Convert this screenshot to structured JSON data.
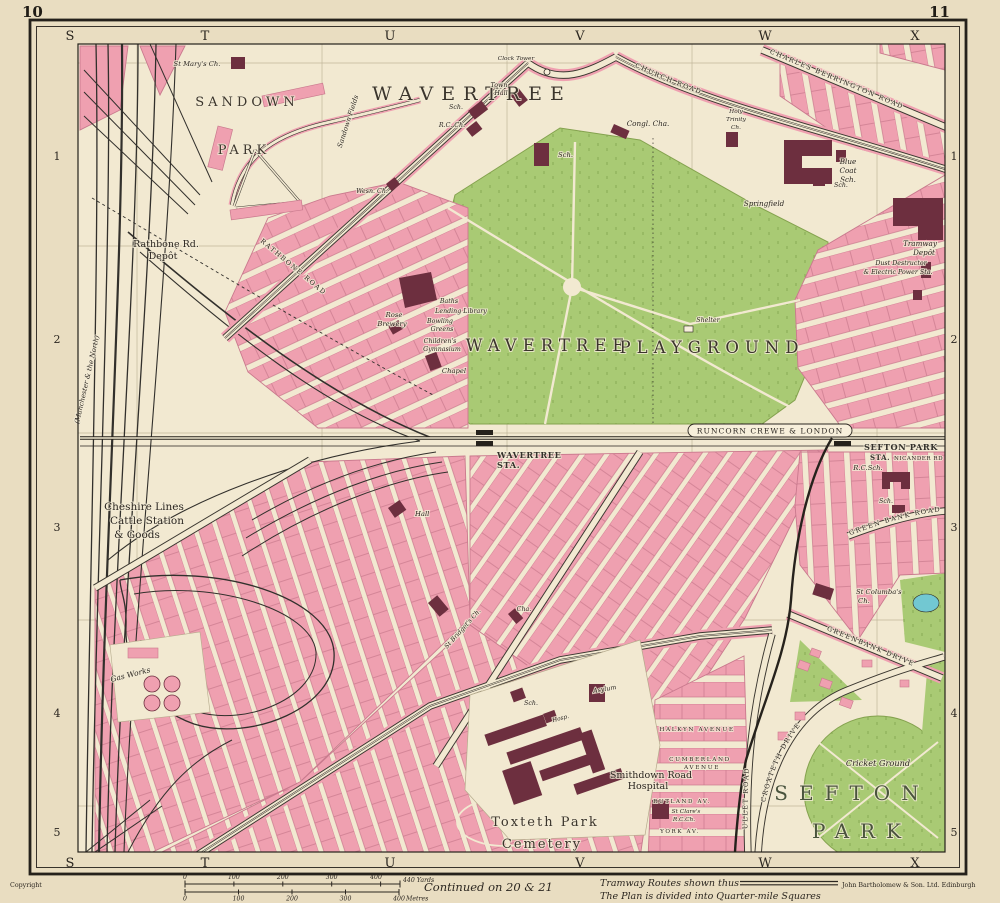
{
  "page": {
    "left_no": "10",
    "right_no": "11"
  },
  "grid": {
    "top_letters": [
      "S",
      "T",
      "U",
      "V",
      "W",
      "X"
    ],
    "bottom_letters": [
      "S",
      "T",
      "U",
      "V",
      "W",
      "X"
    ],
    "left_numbers": [
      "1",
      "2",
      "3",
      "4",
      "5"
    ],
    "right_numbers": [
      "1",
      "2",
      "3",
      "4",
      "5"
    ]
  },
  "labels": {
    "st_marys": "St Mary's Ch.",
    "sandown": "SANDOWN",
    "sandown_park": "PARK",
    "sandown_fields": "Sandown Fields",
    "wavertree": "WAVERTREE",
    "clock_tower": "Clock Tower",
    "town_hall_1": "Town",
    "town_hall_2": "Hall",
    "sch_village": "Sch.",
    "rc_ch": "R.C. Ch.",
    "wesn_ch": "Wesn. Ch.",
    "sch_green": "Sch.",
    "congl_cha": "Congl. Cha.",
    "holy_1": "Holy",
    "holy_2": "Trinity",
    "holy_3": "Ch.",
    "blue_1": "Blue",
    "blue_2": "Coat",
    "blue_3": "Sch.",
    "springfield": "Springfield",
    "sch_ne": "Sch.",
    "church_road": "CHURCH ROAD",
    "charles_berrington": "CHARLES BERRINGTON ROAD",
    "tramway_1": "Tramway",
    "tramway_2": "Depôt",
    "dust_1": "Dust Destructor",
    "dust_2": "& Electric Power Sta.",
    "rathbone_1": "Rathbone Rd.",
    "rathbone_2": "Depôt",
    "manchester": "(Manchester & the North)",
    "rathbone_road": "RATHBONE ROAD",
    "rose_1": "Rose",
    "rose_2": "Brewery",
    "baths": "Baths",
    "lending": "Lending Library",
    "bowling_1": "Bowling",
    "bowling_2": "Greens",
    "gym_1": "Children's",
    "gym_2": "Gymnasium",
    "chapel": "Chapel",
    "playground_1": "WAVERTREE",
    "playground_2": "PLAYGROUND",
    "shelter": "Shelter",
    "runcorn": "RUNCORN CREWE & LONDON",
    "wavertree_sta_1": "WAVERTREE",
    "wavertree_sta_2": "STA.",
    "sefton_sta_1": "SEFTON PARK",
    "sefton_sta_2": "STA.",
    "nicander": "NICANDER RD",
    "rc_sch": "R.C.Sch.",
    "sch_gb": "Sch.",
    "green_bank_road": "GREEN BANK ROAD",
    "columbas_1": "St Columba's",
    "columbas_2": "Ch.",
    "cheshire_1": "Cheshire Lines",
    "cheshire_2": "Cattle Station",
    "cheshire_3": "& Goods",
    "hall": "Hall",
    "st_bridgets": "St Bridget's Ch.",
    "cha": "Cha.",
    "gas_works": "Gas Works",
    "sch_s": "Sch.",
    "hosp": "Hosp.",
    "asylum": "Asylum",
    "smithdown_1": "Smithdown Road",
    "smithdown_2": "Hospital",
    "clares_1": "St Clare's",
    "clares_2": "R.C.Ch.",
    "toxteth_1": "Toxteth Park",
    "toxteth_2": "Cemetery",
    "cricket": "Cricket Ground",
    "sefton_1": "SEFTON",
    "sefton_2": "PARK",
    "croxteth_drive": "CROXTETH DRIVE",
    "greenbank_drive": "GREENBANK DRIVE",
    "ullet_road": "ULLET ROAD",
    "halkyn": "HALKYN AVENUE",
    "cumberland_1": "CUMBERLAND",
    "cumberland_2": "AVENUE",
    "rutland": "RUTLAND AV.",
    "york": "YORK AV."
  },
  "footer": {
    "copyright": "Copyright",
    "continued": "Continued on 20 & 21",
    "tramway_note": "Tramway Routes shown thus",
    "plan_note": "The Plan is divided into Quarter-mile Squares",
    "publisher": "John Bartholomew & Son. Ltd. Edinburgh",
    "scale": {
      "yards_ticks": [
        "0",
        "100",
        "200",
        "300",
        "400"
      ],
      "yards_end": "440 Yards",
      "metres_ticks": [
        "0",
        "100",
        "200",
        "300",
        "400"
      ],
      "metres_end": "Metres"
    }
  },
  "colors": {
    "paper": "#e9ddc1",
    "map_cream": "#f2e9d1",
    "pink": "#efa0b0",
    "pink_dark": "#c9798d",
    "green": "#a9ca74",
    "maroon": "#6d2f3f",
    "rail_black": "#32302c",
    "pond_blue": "#72c8d2",
    "grid_line": "#b5aa8c"
  }
}
